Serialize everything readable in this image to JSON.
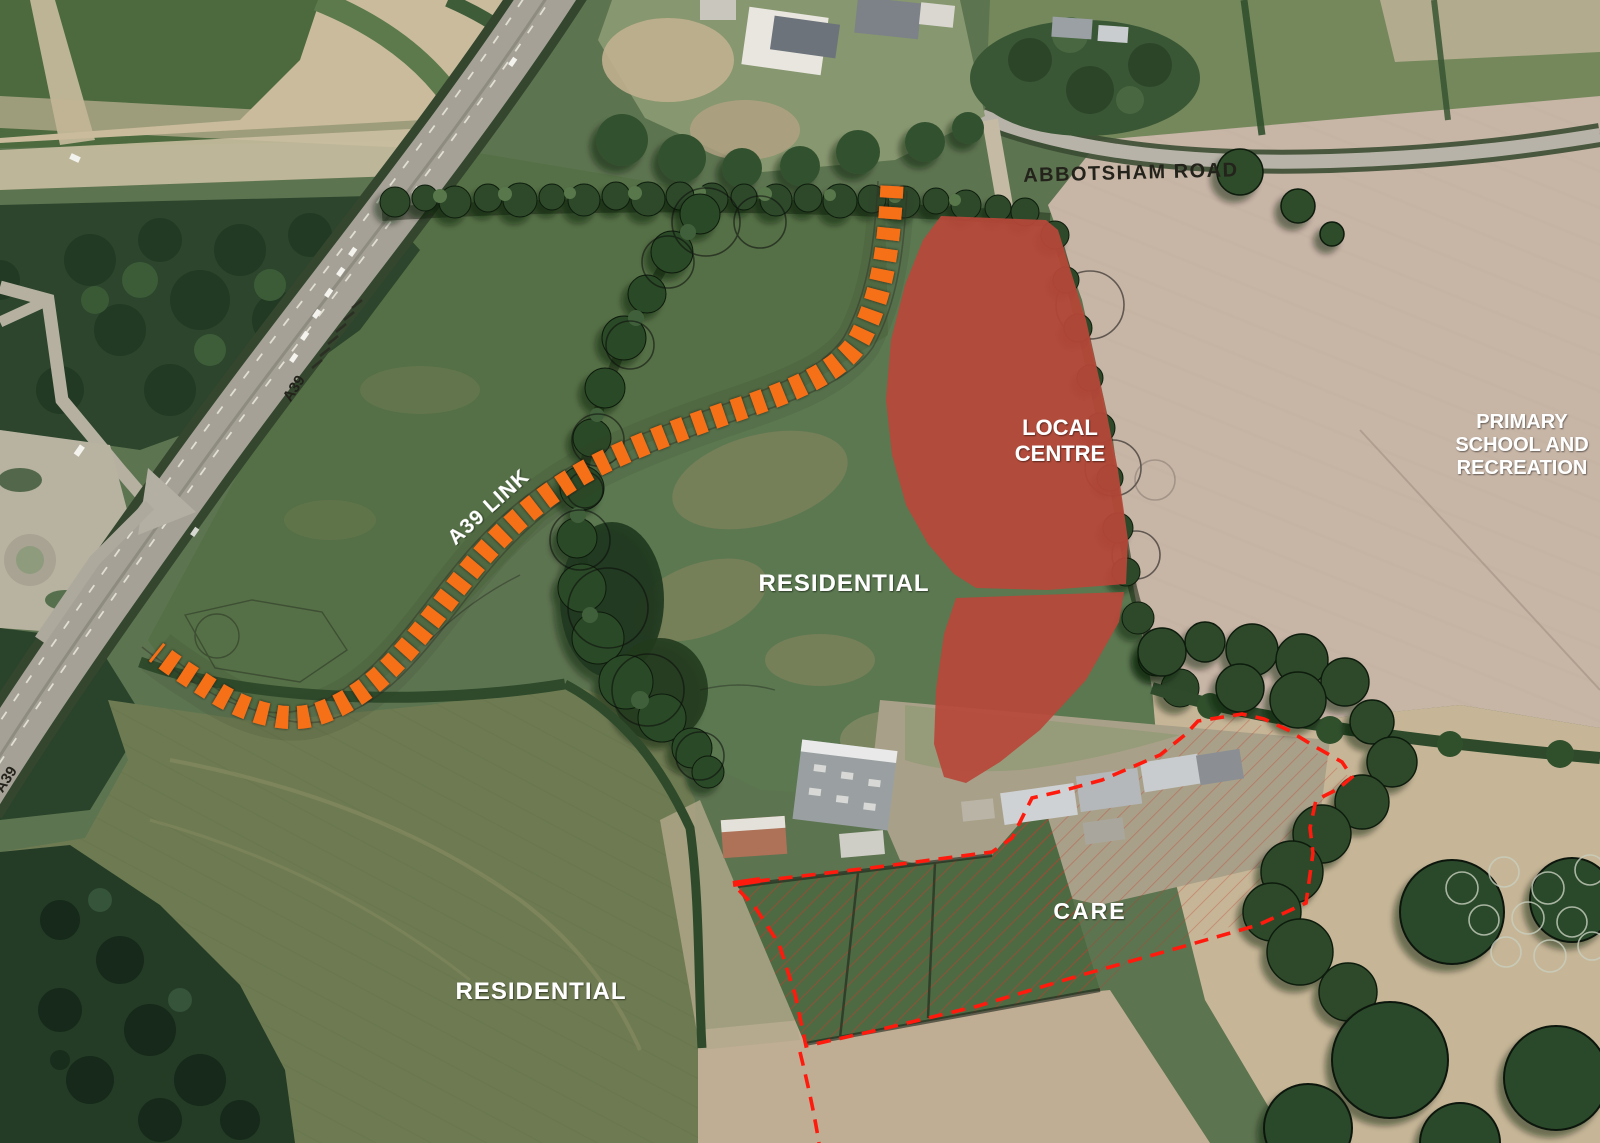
{
  "page": {
    "title": "Aerial masterplan – proposed A39 link and development zones"
  },
  "map": {
    "road_labels": {
      "abbotsham": "ABBOTSHAM ROAD",
      "a39_link": "A39 LINK",
      "a39": "A39",
      "a39_edge": "A39"
    },
    "zone_labels": {
      "local_centre_line1": "LOCAL",
      "local_centre_line2": "CENTRE",
      "primary_line1": "PRIMARY",
      "primary_line2": "SCHOOL AND",
      "primary_line3": "RECREATION",
      "residential_mid": "RESIDENTIAL",
      "residential_sw": "RESIDENTIAL",
      "care": "CARE"
    },
    "legend_colors": {
      "local_centre_fill": "#b9483a",
      "proposed_link_road_dash": "#f56f15",
      "site_boundary_dash": "#ff1a0e"
    }
  }
}
